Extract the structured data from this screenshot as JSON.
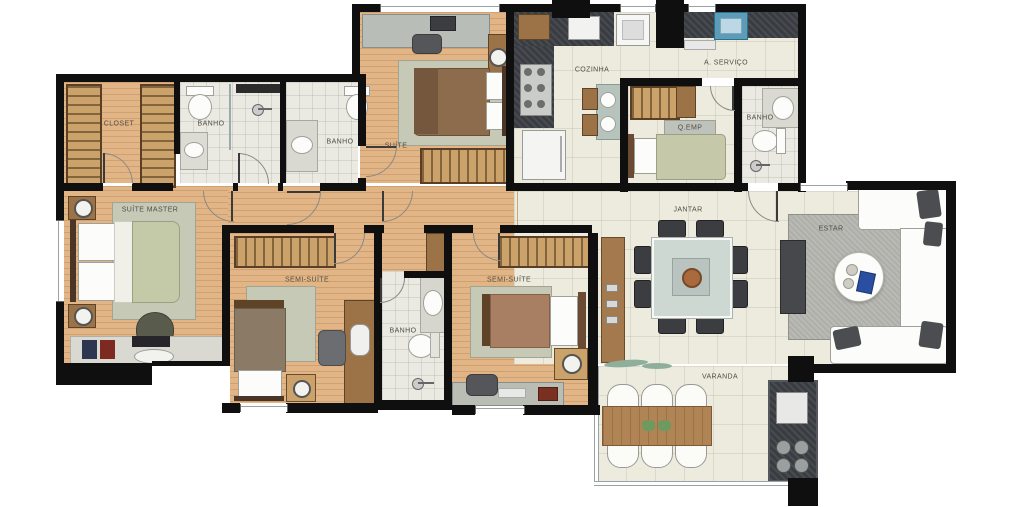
{
  "type": "architectural-floor-plan",
  "rooms": {
    "closet": {
      "label": "CLOSET"
    },
    "banho_master": {
      "label": "BANHO"
    },
    "banho_suite": {
      "label": "BANHO"
    },
    "suite": {
      "label": "SUÍTE"
    },
    "cozinha": {
      "label": "COZINHA"
    },
    "area_servico": {
      "label": "A. SERVIÇO"
    },
    "quarto_empregada": {
      "label": "Q.EMP"
    },
    "banho_servico": {
      "label": "BANHO"
    },
    "suite_master": {
      "label": "SUÍTE MASTER"
    },
    "semi_suite_1": {
      "label": "SEMI-SUÍTE"
    },
    "banho_semi": {
      "label": "BANHO"
    },
    "semi_suite_2": {
      "label": "SEMI-SUÍTE"
    },
    "jantar": {
      "label": "JANTAR"
    },
    "estar": {
      "label": "ESTAR"
    },
    "varanda": {
      "label": "VARANDA"
    }
  },
  "colors": {
    "wall": "#0f0f0f",
    "wood_floor": "#e2b586",
    "tile_floor": "#ecebde",
    "bath_tile": "#eaeae2",
    "granite_counter": "#393c40",
    "wardrobe": "#cba26a",
    "rug_sage": "#c6c9b6",
    "rug_gray": "#b9bab4",
    "label_text": "#4f4e45",
    "tanque_blue": "#5d9cb8",
    "accent_book_blue": "#2b4fa0"
  }
}
